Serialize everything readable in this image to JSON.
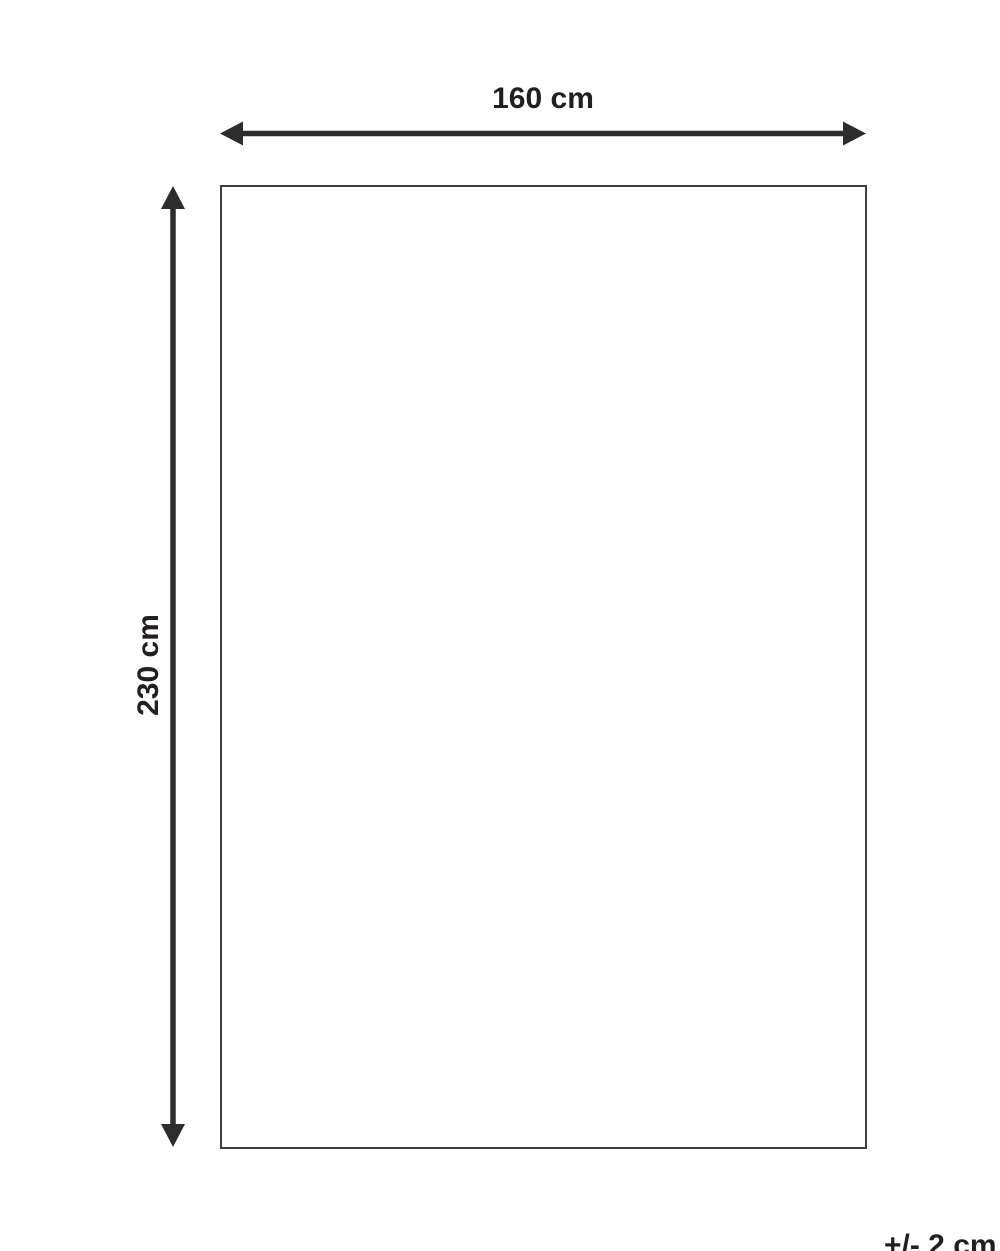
{
  "diagram": {
    "title": "product-dimension-diagram",
    "width_label": "160 cm",
    "height_label": "230 cm",
    "tolerance_label": "+/- 2 cm",
    "colors": {
      "background": "#ffffff",
      "line": "#2d2d2d",
      "rect_border": "#3f3f3f",
      "text": "#231f20"
    }
  }
}
